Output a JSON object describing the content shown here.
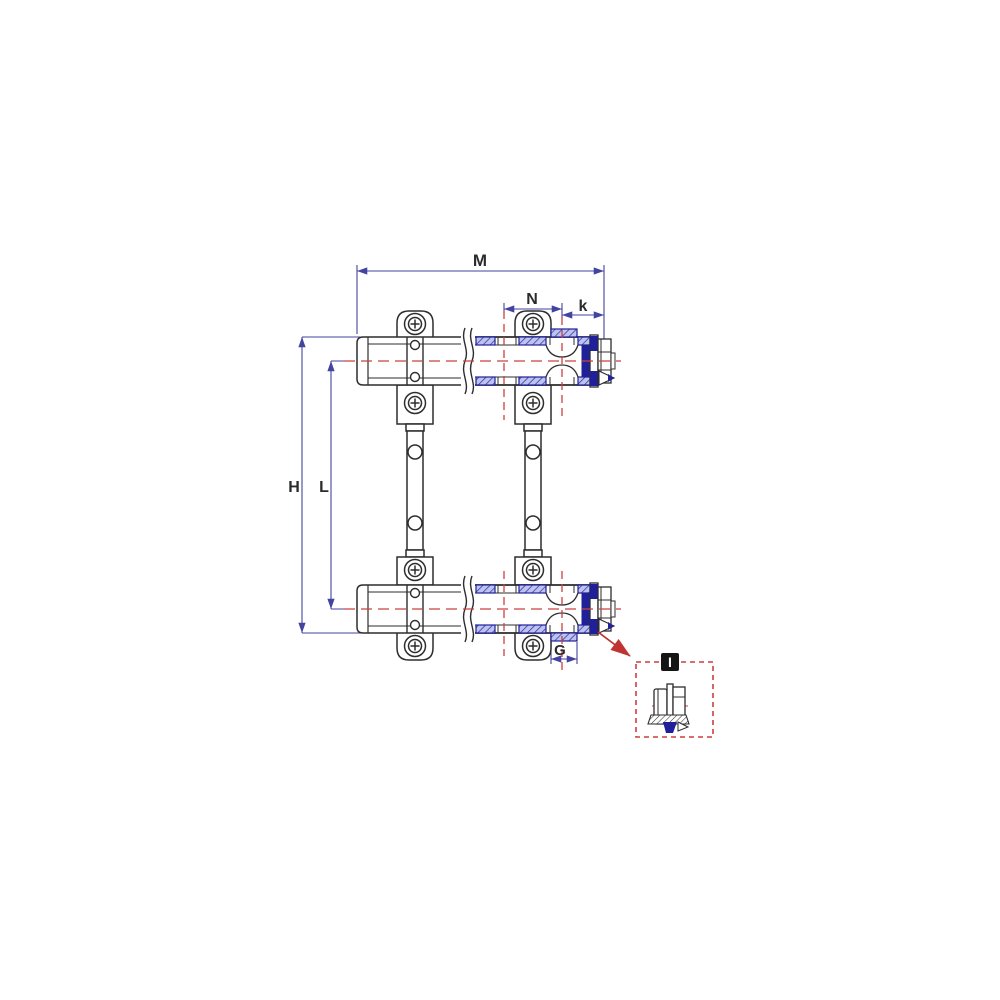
{
  "drawing": {
    "type": "technical-dimension-drawing",
    "subject": "heating-manifold-pair-with-mounting-brackets",
    "dimension_labels": {
      "overall_width": "M",
      "port_spacing": "N",
      "end_offset": "k",
      "overall_height": "H",
      "center_distance": "L",
      "outlet_port": "G"
    },
    "detail_callout": {
      "label": "I"
    }
  },
  "colors": {
    "background": "#ffffff",
    "outline": "#2d2d2d",
    "dimension_line": "#4343a0",
    "centerline_red": "#cc4040",
    "hatch_fill": "#bdc3ee",
    "hatch_line": "#2b2ba3",
    "section_solid_blue": "#20209a",
    "detail_box_red": "#cc3f3f",
    "detail_label_bg": "#151515",
    "detail_label_fg": "#ffffff"
  }
}
